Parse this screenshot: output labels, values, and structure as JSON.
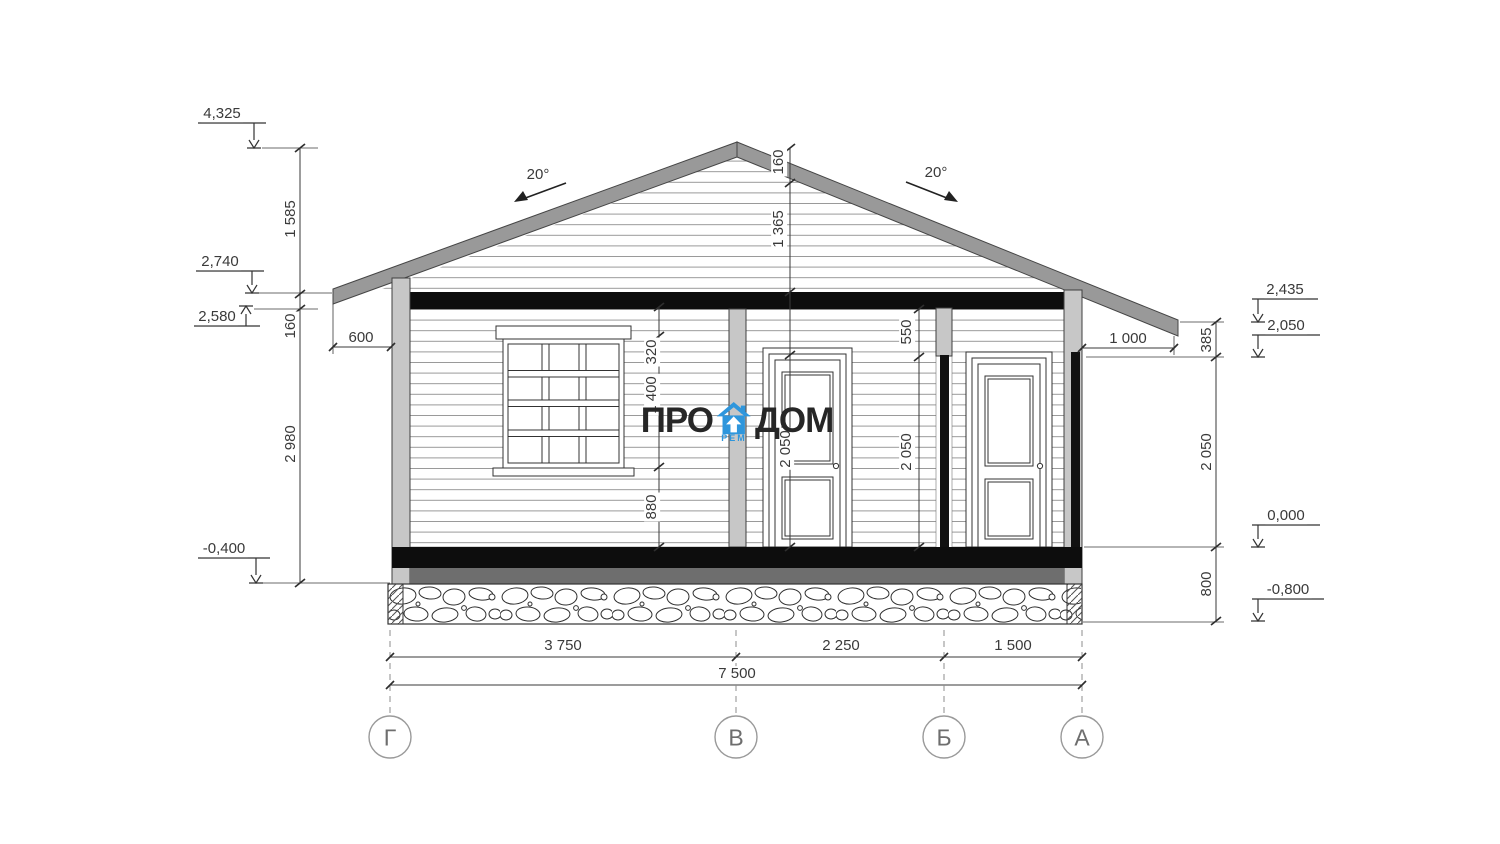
{
  "watermark": {
    "pro": "ПРО",
    "dom": "ДОМ",
    "rem": "РЕМ",
    "icon": "house-icon",
    "accent_color": "#2E96DC"
  },
  "angles": {
    "left": "20°",
    "right": "20°"
  },
  "levels": {
    "e4325": "4,325",
    "e2740": "2,740",
    "e2580": "2,580",
    "em0400": "-0,400",
    "e2435": "2,435",
    "e2050": "2,050",
    "e0000": "0,000",
    "em0800": "-0,800"
  },
  "dims": {
    "v1585": "1 585",
    "v160_left": "160",
    "v2980": "2 980",
    "v160_ridge": "160",
    "v1365": "1 365",
    "v2050_door": "2 050",
    "v320": "320",
    "v1400": "1 400",
    "v880": "880",
    "v550": "550",
    "v2050_mid": "2 050",
    "h600": "600",
    "h1000": "1 000",
    "v385": "385",
    "v2050_right": "2 050",
    "v800": "800",
    "b3750": "3 750",
    "b2250": "2 250",
    "b1500": "1 500",
    "b7500": "7 500"
  },
  "axes": [
    {
      "label": "Г"
    },
    {
      "label": "В"
    },
    {
      "label": "Б"
    },
    {
      "label": "А"
    }
  ]
}
